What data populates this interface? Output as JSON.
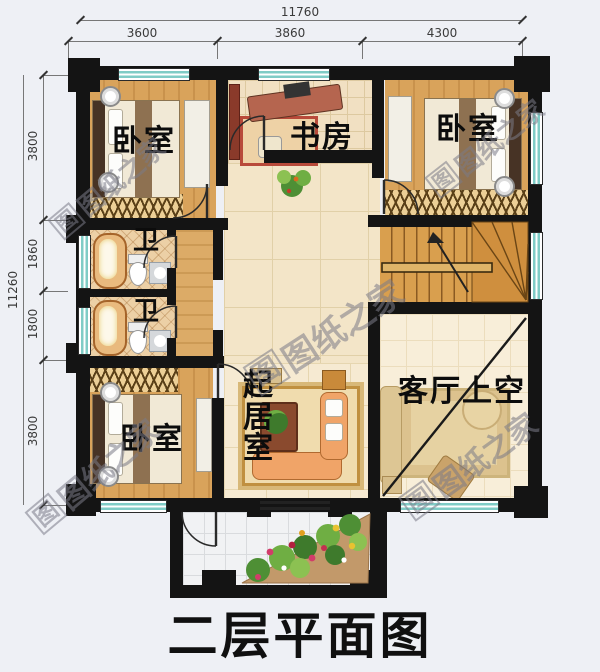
{
  "title": "二层平面图",
  "watermark": {
    "text": "图纸之家",
    "logo": "图"
  },
  "dims": {
    "top": {
      "total": "11760",
      "segments": [
        "3600",
        "3860",
        "4300"
      ]
    },
    "left": {
      "total": "11260",
      "segments": [
        "3800",
        "1860",
        "1800",
        "3800"
      ]
    }
  },
  "rooms": {
    "bedroom_top_left": "卧室",
    "study": "书房",
    "bedroom_top_right": "卧室",
    "bath_1": "卫",
    "bath_2": "卫",
    "bedroom_bottom_left": "卧室",
    "living_room": "起居室",
    "void_over_living": "客厅上空"
  },
  "colors": {
    "wall": "#141414",
    "window_glass": "#7fccc6",
    "wood_floor": "#d9a35b",
    "tile_floor": "#f3e5c8",
    "title_text": "#101010"
  }
}
